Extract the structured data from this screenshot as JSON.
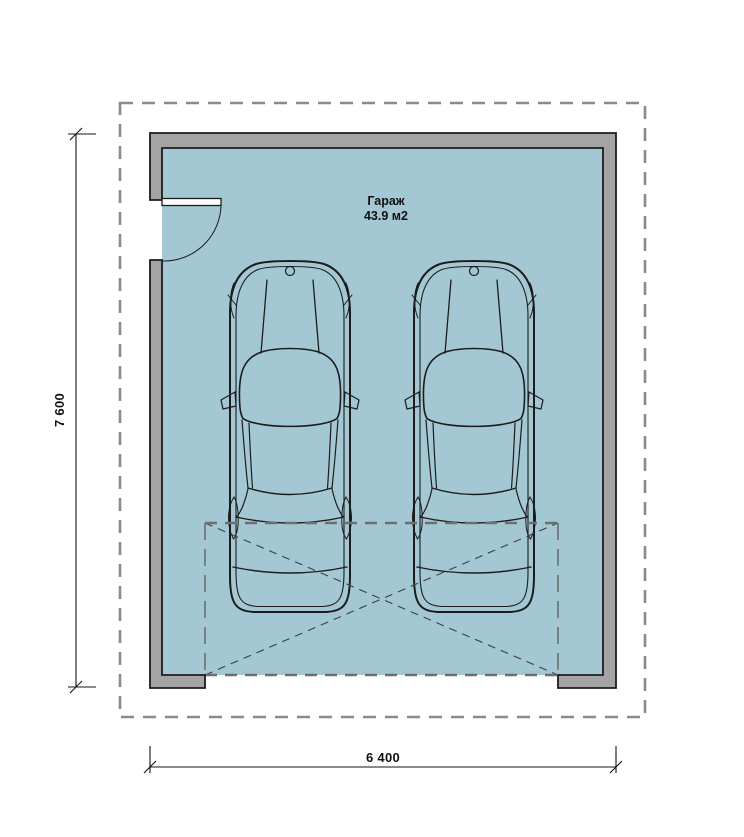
{
  "plan": {
    "room_label": "Гараж",
    "room_area": "43.9 м2",
    "dim_vertical": "7 600",
    "dim_horizontal": "6 400"
  },
  "colors": {
    "wall_fill": "#a4a4a4",
    "floor_fill": "#a3c8d4",
    "line": "#1c1c1c",
    "dash_gray": "#8a8a8a",
    "door_dash": "#6f6f6f",
    "diag_dash": "#3f3f3f"
  }
}
